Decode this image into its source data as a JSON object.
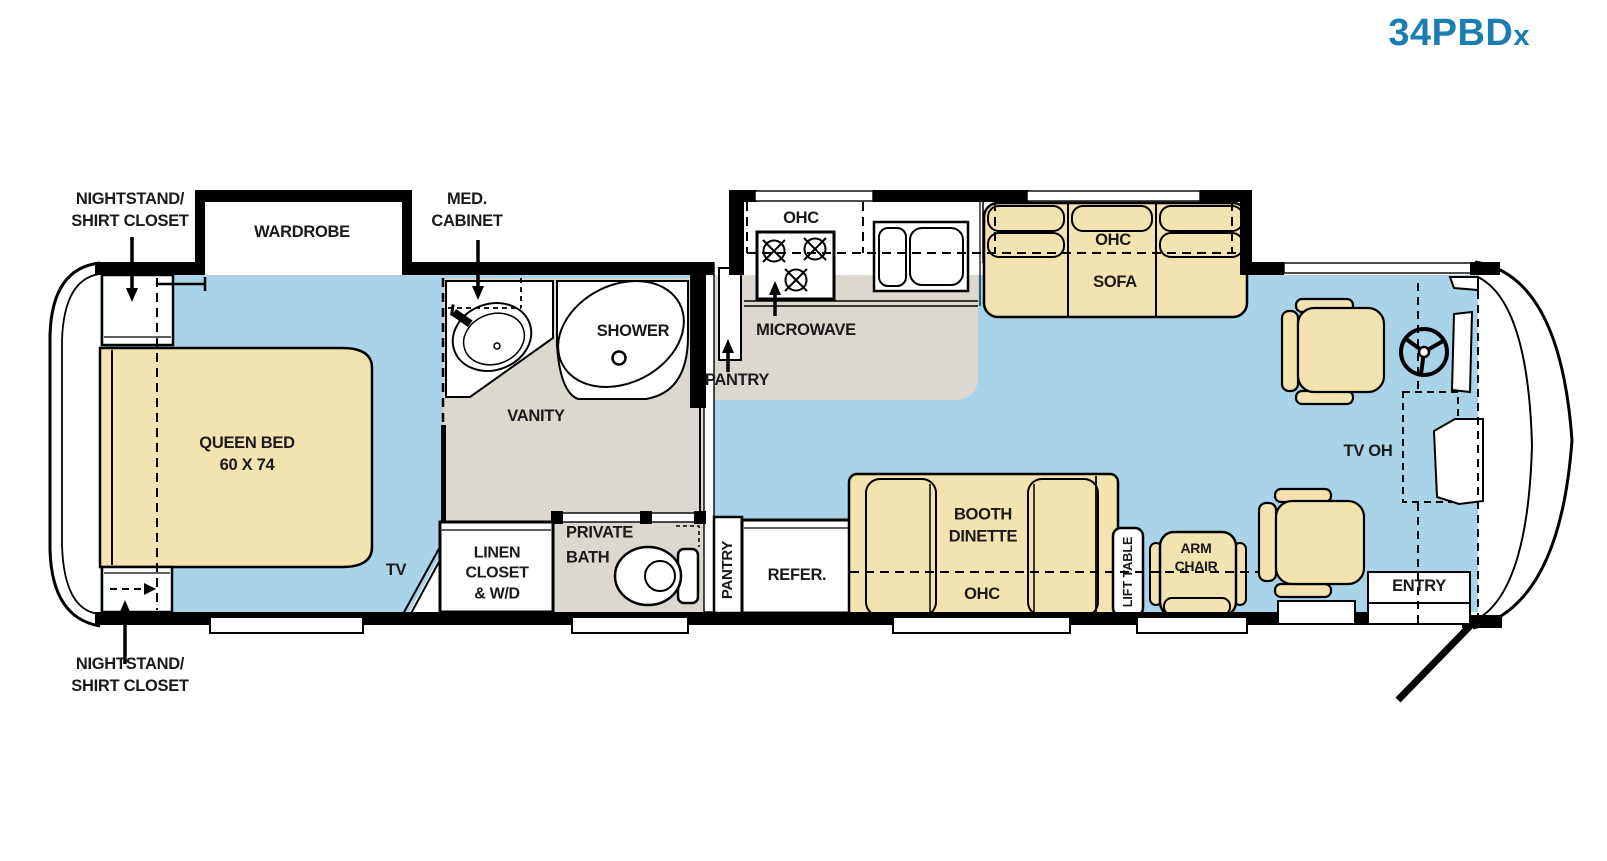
{
  "title": {
    "model": "34PBD",
    "suffix": "x"
  },
  "colors": {
    "floor_blue": "#a9d3e8",
    "furniture_tan": "#f2e3b0",
    "floor_gray": "#dcd8d0",
    "wall_black": "#000000",
    "title_blue": "#1a7eb0",
    "label_text": "#1a1a1a"
  },
  "labels": {
    "nightstand_top": "NIGHTSTAND/\nSHIRT CLOSET",
    "wardrobe": "WARDROBE",
    "med_cabinet": "MED.\nCABINET",
    "shower": "SHOWER",
    "vanity": "VANITY",
    "queen_bed": "QUEEN BED\n60 X 74",
    "tv": "TV",
    "linen_closet": "LINEN\nCLOSET\n& W/D",
    "private_bath": "PRIVATE\nBATH",
    "pantry_upper": "PANTRY",
    "microwave": "MICROWAVE",
    "ohc_kitchen": "OHC",
    "ohc_sofa": "OHC",
    "sofa": "SOFA",
    "pantry_lower": "PANTRY",
    "refer": "REFER.",
    "booth_dinette": "BOOTH\nDINETTE",
    "ohc_booth": "OHC",
    "lift_table": "LIFT TABLE",
    "arm_chair": "ARM\nCHAIR",
    "tv_oh": "TV OH",
    "entry": "ENTRY",
    "nightstand_bottom": "NIGHTSTAND/\nSHIRT CLOSET"
  }
}
